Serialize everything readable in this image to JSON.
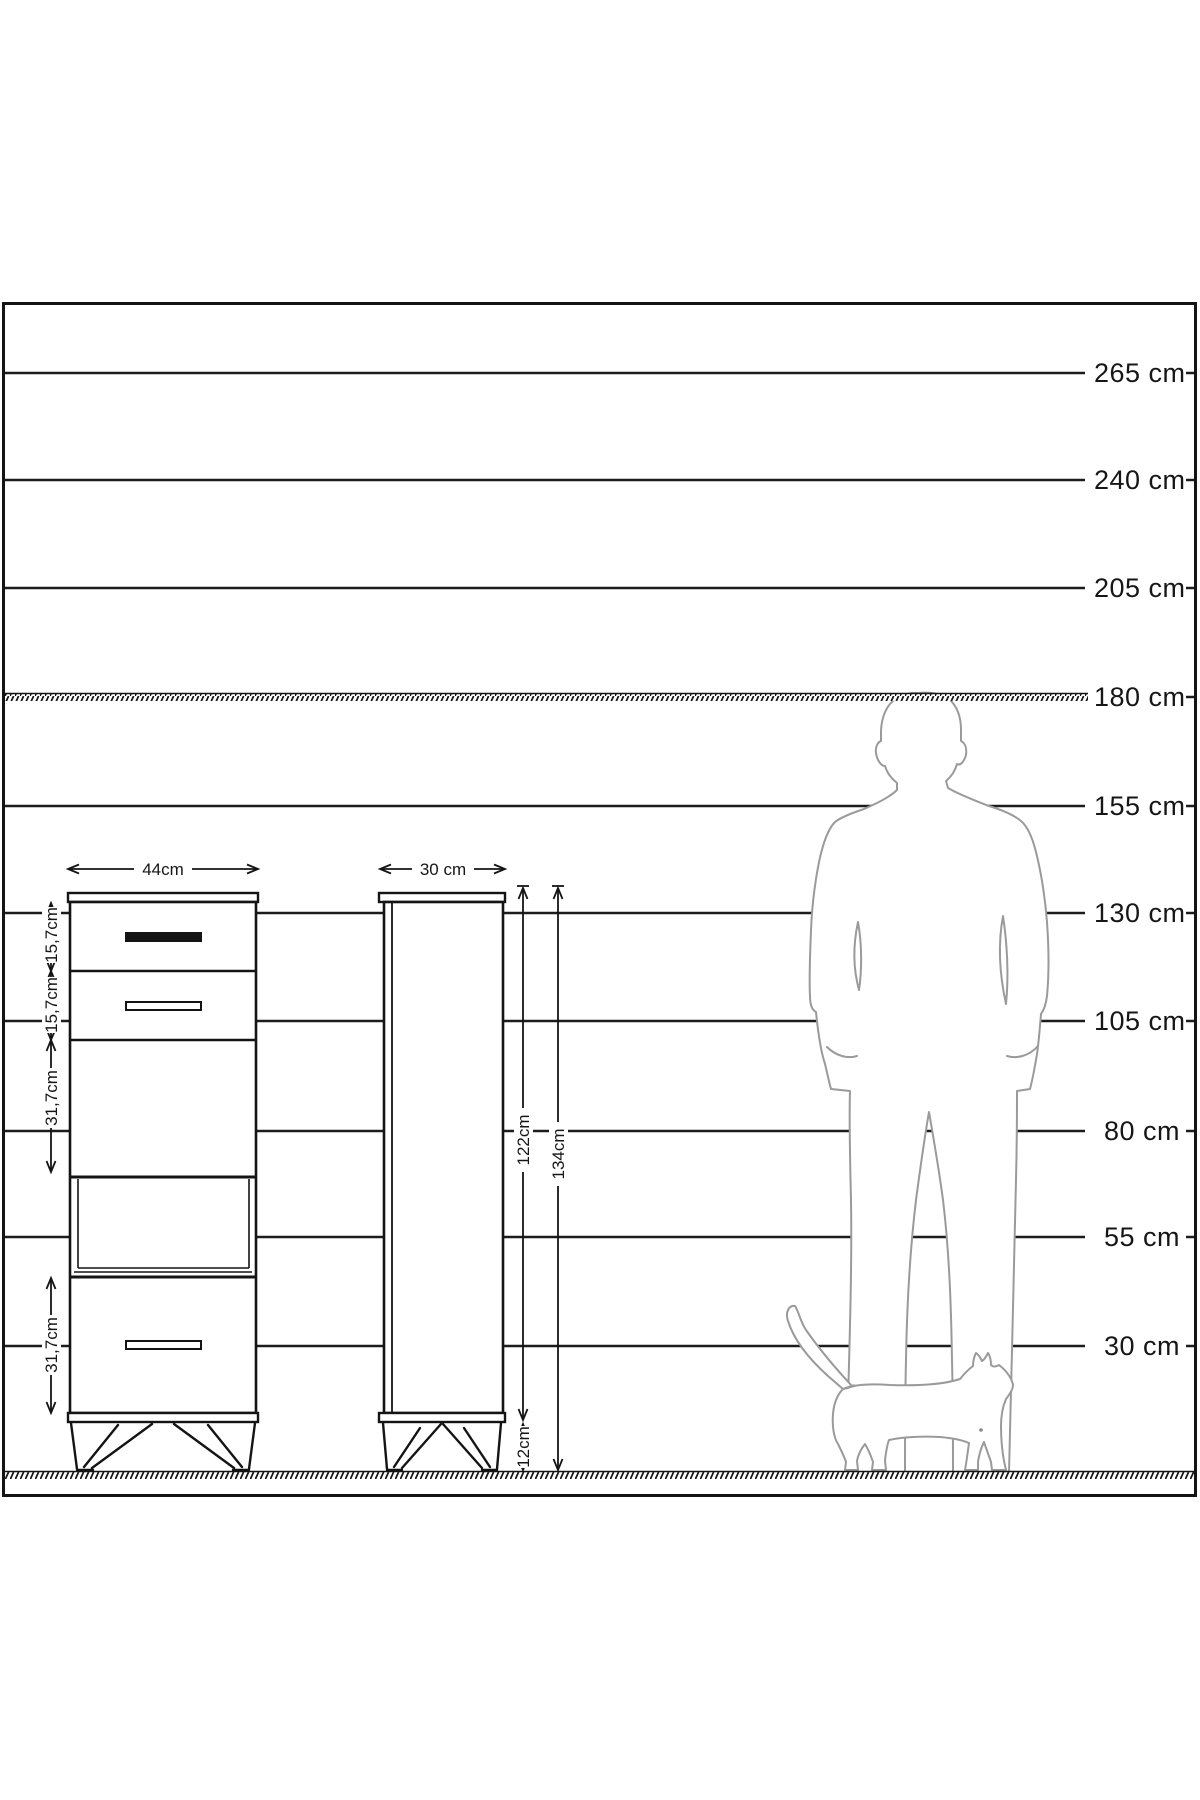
{
  "diagram": {
    "type": "furniture-size-diagram",
    "unit": "cm"
  },
  "scale": {
    "labels": [
      "265 cm",
      "240 cm",
      "205 cm",
      "180 cm",
      "155 cm",
      "130 cm",
      "105 cm",
      "80 cm",
      "55 cm",
      "30 cm"
    ]
  },
  "front_view": {
    "width": "44cm",
    "section_heights": [
      "15,7cm",
      "15,7cm",
      "31,7cm",
      "31,7cm"
    ]
  },
  "side_view": {
    "depth": "30 cm",
    "body_height": "122cm",
    "total_height": "134cm",
    "leg_height": "12cm"
  },
  "figures": {
    "person": "standing-man-silhouette",
    "cat": "walking-cat-silhouette"
  },
  "colors": {
    "ink": "#161616",
    "figure_outline": "#9a9a9a",
    "background": "#ffffff"
  }
}
